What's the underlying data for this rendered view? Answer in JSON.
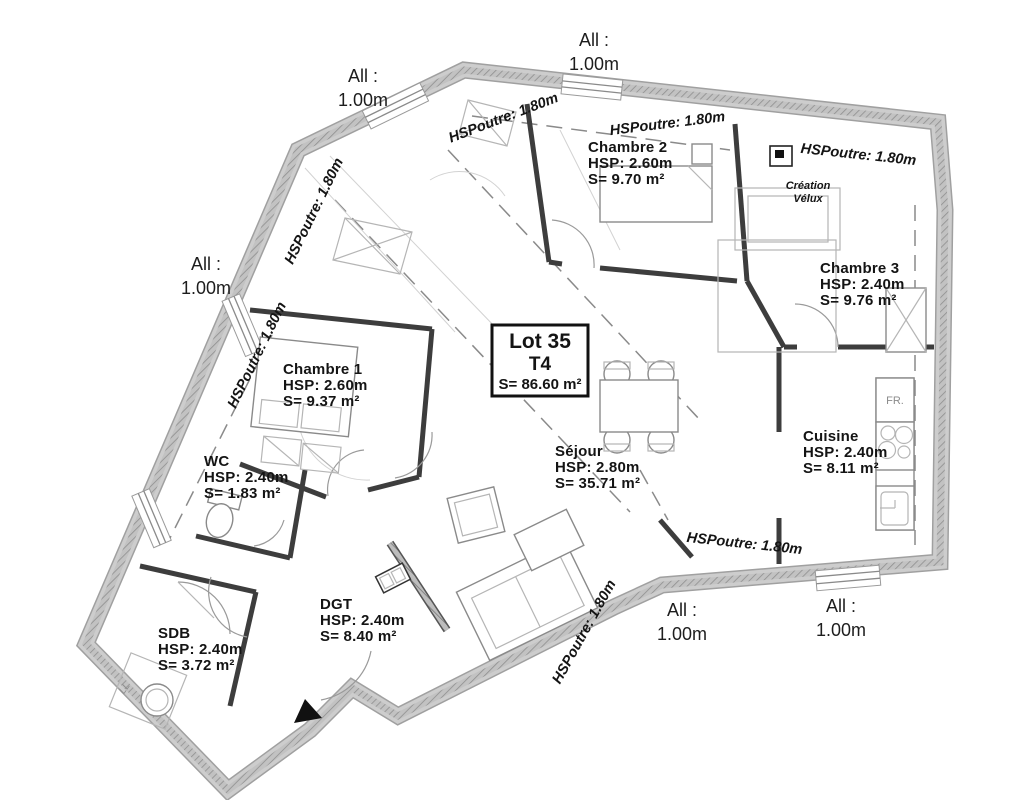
{
  "lot": {
    "name": "Lot 35",
    "type": "T4",
    "area": "S= 86.60 m²"
  },
  "rooms": [
    {
      "id": "chambre2",
      "name": "Chambre 2",
      "hsp": "HSP:  2.60m",
      "area": "S= 9.70 m²"
    },
    {
      "id": "chambre3",
      "name": "Chambre 3",
      "hsp": "HSP:  2.40m",
      "area": "S= 9.76 m²"
    },
    {
      "id": "chambre1",
      "name": "Chambre 1",
      "hsp": "HSP:  2.60m",
      "area": "S= 9.37 m²"
    },
    {
      "id": "cuisine",
      "name": "Cuisine",
      "hsp": "HSP:  2.40m",
      "area": "S= 8.11 m²"
    },
    {
      "id": "sejour",
      "name": "Séjour",
      "hsp": "HSP:  2.80m",
      "area": "S= 35.71 m²"
    },
    {
      "id": "wc",
      "name": "WC",
      "hsp": "HSP:  2.40m",
      "area": "S= 1.83 m²"
    },
    {
      "id": "sdb",
      "name": "SDB",
      "hsp": "HSP:  2.40m",
      "area": "S= 3.72 m²"
    },
    {
      "id": "dgt",
      "name": "DGT",
      "hsp": "HSP:  2.40m",
      "area": "S= 8.40 m²"
    }
  ],
  "annotations": {
    "allege_label": "All :",
    "allege_value": "1.00m",
    "beam": "HSPoutre: 1.80m",
    "velux_line1": "Création",
    "velux_line2": "Vélux",
    "fridge": "FR.",
    "washer": "LL"
  },
  "colors": {
    "wall_fill": "#cdcdcd",
    "wall_edge": "#a9a9a9",
    "insulation_hatch": "#8f8f8f",
    "partition": "#3d3d3d",
    "text": "#141414",
    "furniture": "#8a8a8a"
  }
}
